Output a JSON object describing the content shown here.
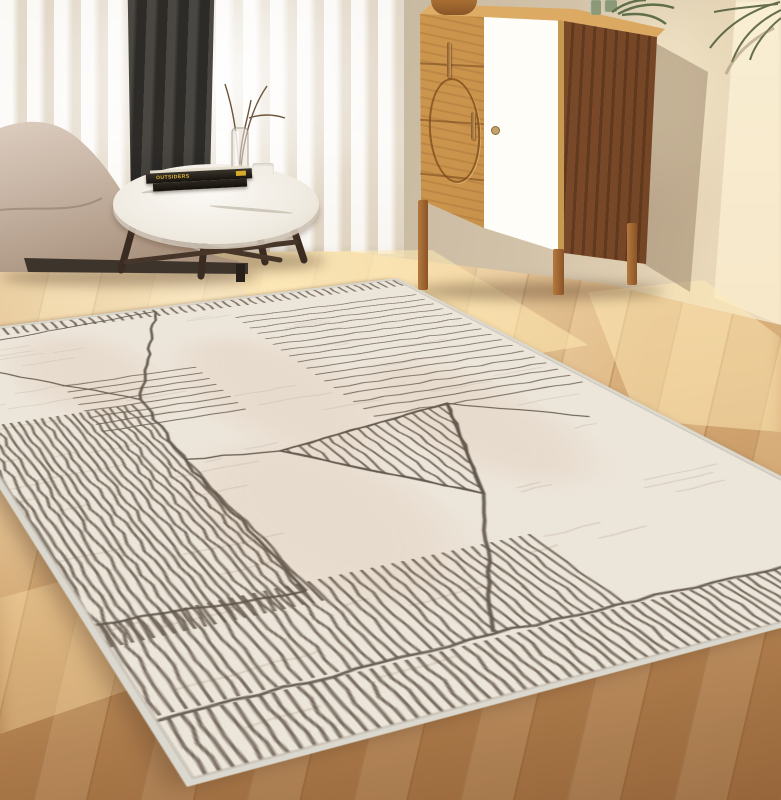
{
  "scene": {
    "type": "interior-product-photo",
    "objects": [
      "area-rug",
      "wood-floor",
      "sofa",
      "coffee-table",
      "books",
      "candle",
      "glass-vase",
      "sheer-curtain",
      "dark-drape",
      "sideboard-cabinet",
      "wooden-bowl",
      "green-glass-jars",
      "plant",
      "palm-frond"
    ],
    "book_title": "OUTSIDERS"
  },
  "palette": {
    "wall": "#c5b7a0",
    "wall_sunlit": "#f4e2c0",
    "floor_light": "#e7c694",
    "floor_dark": "#96663b",
    "rug_base": "#ece5d9",
    "rug_line": "#60564b",
    "rug_binding": "#dbd8cf",
    "cabinet_oak": "#c8914a",
    "cabinet_walnut": "#7d4c2a",
    "cabinet_door": "#fdfcf8",
    "sofa": "#c4b1a1",
    "drape": "#3a3834",
    "book_accent": "#d8a92c"
  },
  "rug": {
    "local": {
      "w": 700,
      "h": 500
    },
    "quad": {
      "t": [
        397,
        278
      ],
      "r": [
        975,
        576
      ],
      "l": [
        -95,
        338
      ],
      "b": [
        187,
        787
      ]
    },
    "base_color": "#ece5d9",
    "line_color": "#60564b",
    "stripe_color": "#6a5e51",
    "binding_color": "#dbd8cf",
    "texture_color": "#b7a493",
    "tint_color": "#ddc3b0",
    "stripe_groups": [
      {
        "name": "end-ticks",
        "dir": "h",
        "x0": 6,
        "x1": 27,
        "y0": 8,
        "y1": 494,
        "step": 9,
        "w": 2.4
      },
      {
        "name": "cross-stripes-far",
        "dir": "v",
        "x0": 60,
        "x1": 332,
        "y0": 12,
        "y1": 206,
        "step": 17,
        "w": 2
      },
      {
        "name": "cross-stripes-left",
        "dir": "v",
        "x0": 174,
        "x1": 292,
        "y0": 290,
        "y1": 406,
        "step": 15,
        "w": 2
      },
      {
        "name": "length-stripes-mid",
        "dir": "h",
        "x0": 236,
        "x1": 572,
        "y0": 368,
        "y1": 497,
        "step": 6,
        "w": 2
      },
      {
        "name": "length-stripes-right",
        "dir": "h",
        "x0": 548,
        "x1": 642,
        "y0": 212,
        "y1": 497,
        "step": 7,
        "w": 2
      },
      {
        "name": "end-band",
        "dir": "h",
        "x0": 646,
        "x1": 696,
        "y0": 6,
        "y1": 496,
        "step": 7,
        "w": 2.2
      }
    ],
    "triangle": {
      "points": [
        [
          330,
          140
        ],
        [
          365,
          300
        ],
        [
          485,
          205
        ]
      ],
      "step": 9,
      "w": 2
    },
    "network": [
      [
        [
          12,
          268
        ],
        [
          40,
          432
        ]
      ],
      [
        [
          12,
          268
        ],
        [
          228,
          358
        ]
      ],
      [
        [
          228,
          358
        ],
        [
          96,
          468
        ]
      ],
      [
        [
          228,
          358
        ],
        [
          360,
          369
        ],
        [
          558,
          372
        ]
      ],
      [
        [
          330,
          140
        ],
        [
          398,
          54
        ]
      ],
      [
        [
          330,
          140
        ],
        [
          365,
          300
        ]
      ],
      [
        [
          365,
          300
        ],
        [
          485,
          205
        ]
      ],
      [
        [
          485,
          205
        ],
        [
          330,
          140
        ]
      ],
      [
        [
          485,
          205
        ],
        [
          640,
          298
        ]
      ],
      [
        [
          365,
          300
        ],
        [
          352,
          368
        ]
      ],
      [
        [
          558,
          372
        ],
        [
          546,
          496
        ]
      ],
      [
        [
          646,
          10
        ],
        [
          642,
          300
        ],
        [
          646,
          496
        ]
      ]
    ]
  }
}
